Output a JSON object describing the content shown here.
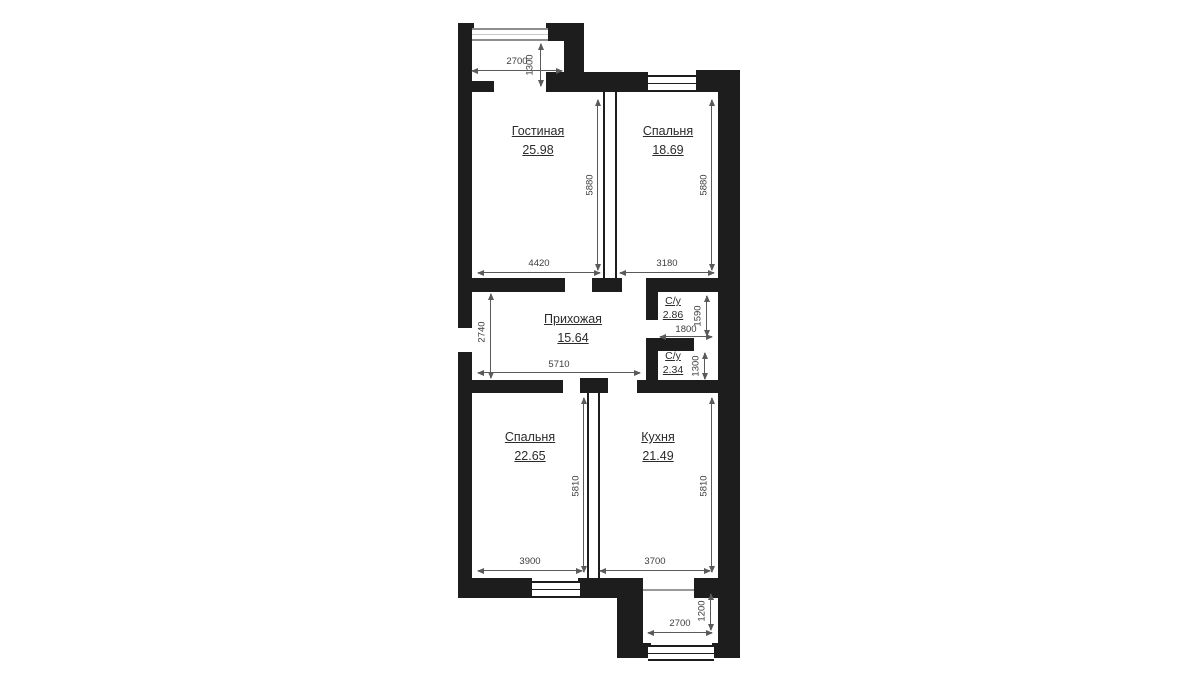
{
  "plan_title": "Apartment floor plan",
  "rooms": [
    {
      "name": "Гостиная",
      "area": "25.98"
    },
    {
      "name": "Спальня",
      "area": "18.69"
    },
    {
      "name": "Прихожая",
      "area": "15.64"
    },
    {
      "name": "С/у",
      "area": "2.86"
    },
    {
      "name": "С/у",
      "area": "2.34"
    },
    {
      "name": "Спальня",
      "area": "22.65"
    },
    {
      "name": "Кухня",
      "area": "21.49"
    }
  ],
  "dims": {
    "top_balcony_width": "2700",
    "top_balcony_depth": "1300",
    "living_width": "4420",
    "bedroom1_width": "3180",
    "living_height": "5880",
    "bedroom1_height": "5880",
    "hall_height": "2740",
    "hall_width": "5710",
    "wc1_height": "1590",
    "wc_width": "1800",
    "wc2_height": "1300",
    "bedroom2_width": "3900",
    "kitchen_width": "3700",
    "bedroom2_height": "5810",
    "kitchen_height": "5810",
    "bottom_balcony_width": "2700",
    "bottom_balcony_depth": "1200"
  },
  "colors": {
    "wall": "#1d1d1d",
    "dimension": "#5a5a5a",
    "window": "#8e8e8e",
    "background": "#ffffff"
  }
}
